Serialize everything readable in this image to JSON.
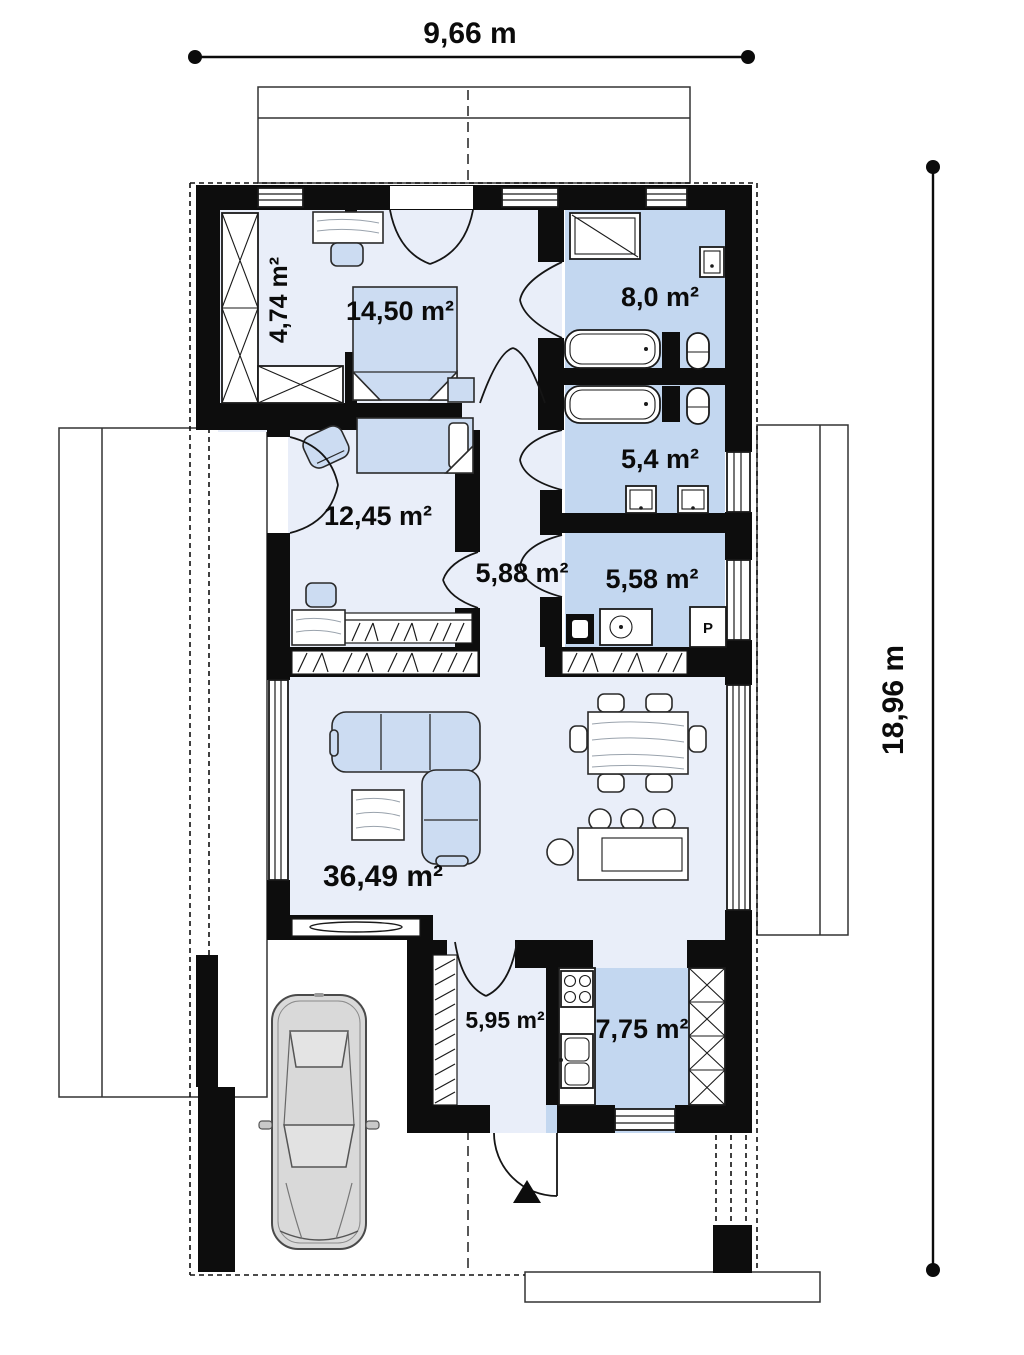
{
  "title": "single-storey house floor plan",
  "dimensions": {
    "top": "9,66 m",
    "right": "18,96 m"
  },
  "rooms": [
    {
      "id": "wardrobe",
      "area": "4,74 m²"
    },
    {
      "id": "bedroom-1",
      "area": "14,50 m²"
    },
    {
      "id": "bathroom-1",
      "area": "8,0 m²"
    },
    {
      "id": "bedroom-2",
      "area": "12,45 m²"
    },
    {
      "id": "bathroom-2",
      "area": "5,4 m²"
    },
    {
      "id": "hallway",
      "area": "5,88 m²"
    },
    {
      "id": "utility",
      "area": "5,58 m²"
    },
    {
      "id": "living-room",
      "area": "36,49 m²"
    },
    {
      "id": "entry",
      "area": "5,95 m²"
    },
    {
      "id": "kitchen",
      "area": "7,75 m²"
    }
  ],
  "labels": {
    "boiler": "P"
  },
  "colors": {
    "wall": "#0d0d0d",
    "room_light": "#e9eef9",
    "room_blue": "#c3d7f0",
    "furniture_blue": "#ccdcf2",
    "car_body": "#d9d9d9"
  }
}
